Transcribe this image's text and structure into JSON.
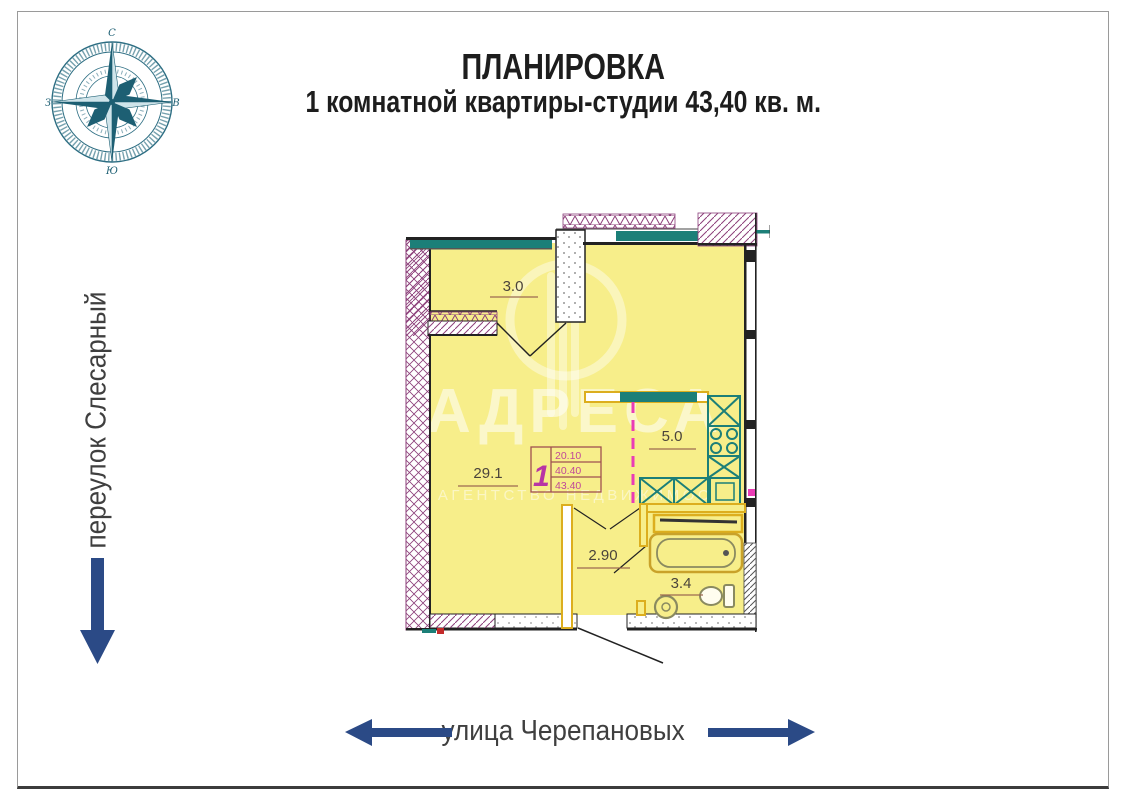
{
  "title": {
    "line1": "ПЛАНИРОВКА",
    "line2": "1 комнатной квартиры-студии 43,40 кв. м."
  },
  "streets": {
    "left_vertical": "переулок Слесарный",
    "bottom": "улица Черепановых"
  },
  "compass": {
    "top": "С",
    "right": "В",
    "bottom": "Ю",
    "left": "З"
  },
  "watermark": {
    "brand": "АДРЕСА",
    "subtitle": "АГЕНТСТВО НЕДВИЖИМОС"
  },
  "floor_plan": {
    "rooms": [
      {
        "name": "loggia",
        "area_label": "3.0"
      },
      {
        "name": "living-room",
        "area_label": "29.1"
      },
      {
        "name": "kitchen",
        "area_label": "5.0"
      },
      {
        "name": "hallway",
        "area_label": "2.90"
      },
      {
        "name": "bathroom",
        "area_label": "3.4"
      }
    ],
    "stamp": {
      "apartment_number": "1",
      "rows": [
        "20.10",
        "40.40",
        "43.40"
      ]
    }
  },
  "colors": {
    "room_fill": "#f7ee8a",
    "wall_hatch_purple": "#8c3f7a",
    "window_teal": "#1c7f78",
    "fixture_gold": "#dcae1e",
    "axis_magenta": "#ea3cb5",
    "arrow_navy": "#2b4a86",
    "compass_teal": "#2d6e83"
  }
}
